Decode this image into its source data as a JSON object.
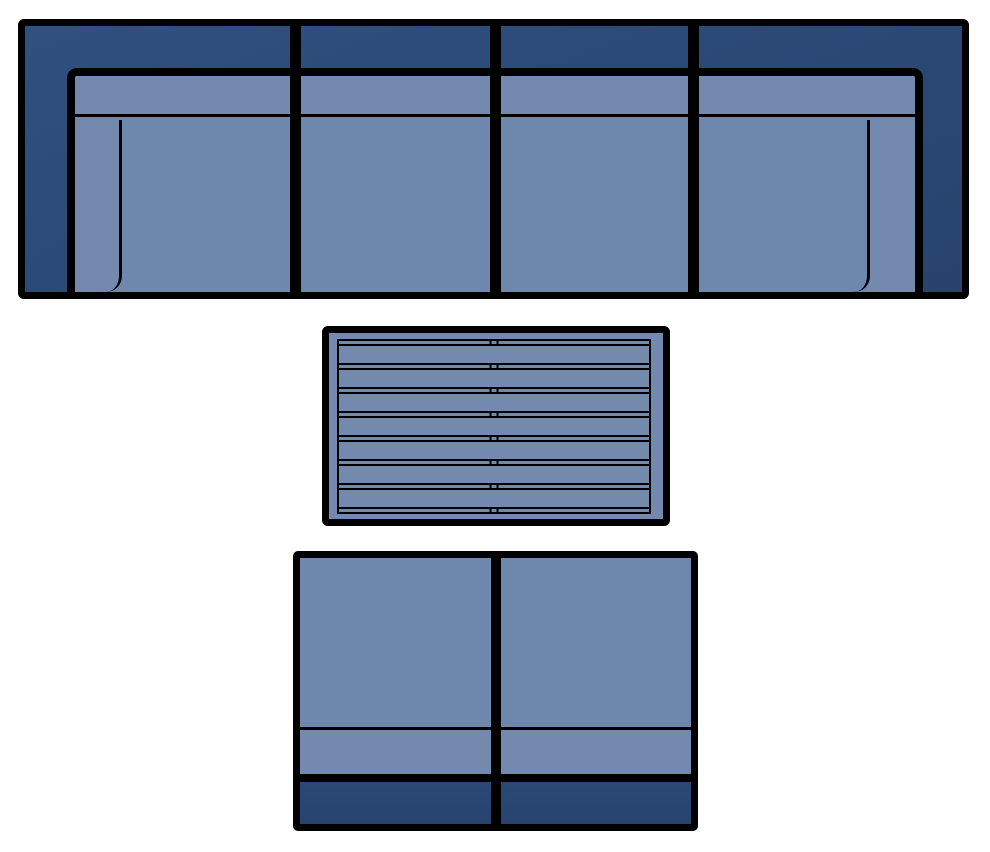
{
  "title": "Outdoor furniture set - top view plan",
  "colors": {
    "outline": "#000000",
    "frame_dark_blue": "#2b4875",
    "cushion_strip_blue": "#7389ae",
    "seat_blue": "#6e87ac",
    "background": "#ffffff"
  },
  "sofa": {
    "name": "four-seat sofa",
    "section_count": 4,
    "sections": [
      {
        "label": "left arm seat",
        "arm": "left"
      },
      {
        "label": "armless seat",
        "arm": "none"
      },
      {
        "label": "armless seat",
        "arm": "none"
      },
      {
        "label": "right arm seat",
        "arm": "right"
      }
    ]
  },
  "coffee_table": {
    "name": "slatted coffee table",
    "slats": 7,
    "separators": 8,
    "center_ticks": true
  },
  "bench": {
    "name": "two-seat bench",
    "section_count": 2,
    "sections": [
      {
        "label": "armless seat"
      },
      {
        "label": "armless seat"
      }
    ]
  }
}
